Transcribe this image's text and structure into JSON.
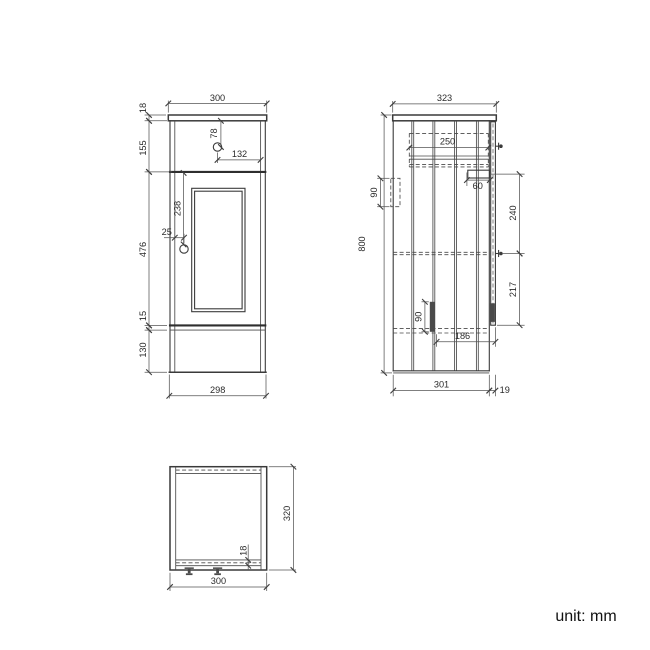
{
  "colors": {
    "background": "#ffffff",
    "object_line": "#3a3a3a",
    "dimension_line": "#555555",
    "text": "#2b2b2b"
  },
  "front_view": {
    "dims": {
      "top_width": "300",
      "countertop_thickness": "18",
      "drawer_front_height": "155",
      "door_height": "476",
      "bottom_rail_height": "15",
      "plinth_height": "130",
      "drawer_knob_from_top": "78",
      "drawer_knob_from_side": "132",
      "door_knob_from_top": "238",
      "door_knob_from_edge": "25",
      "bottom_width": "298"
    }
  },
  "side_view": {
    "dims": {
      "top_depth": "323",
      "overall_height": "800",
      "drawer_depth": "250",
      "hinge_inset": "60",
      "wall_bracket_height": "90",
      "hinge_to_knob": "240",
      "knob_to_door_bottom": "217",
      "runner_height": "90",
      "runner_to_front": "186",
      "carcass_depth": "301",
      "door_thickness": "19"
    }
  },
  "plan_view": {
    "dims": {
      "width": "300",
      "depth": "320",
      "front_rail_thickness": "18"
    }
  },
  "footer": {
    "unit_label": "unit: mm"
  }
}
